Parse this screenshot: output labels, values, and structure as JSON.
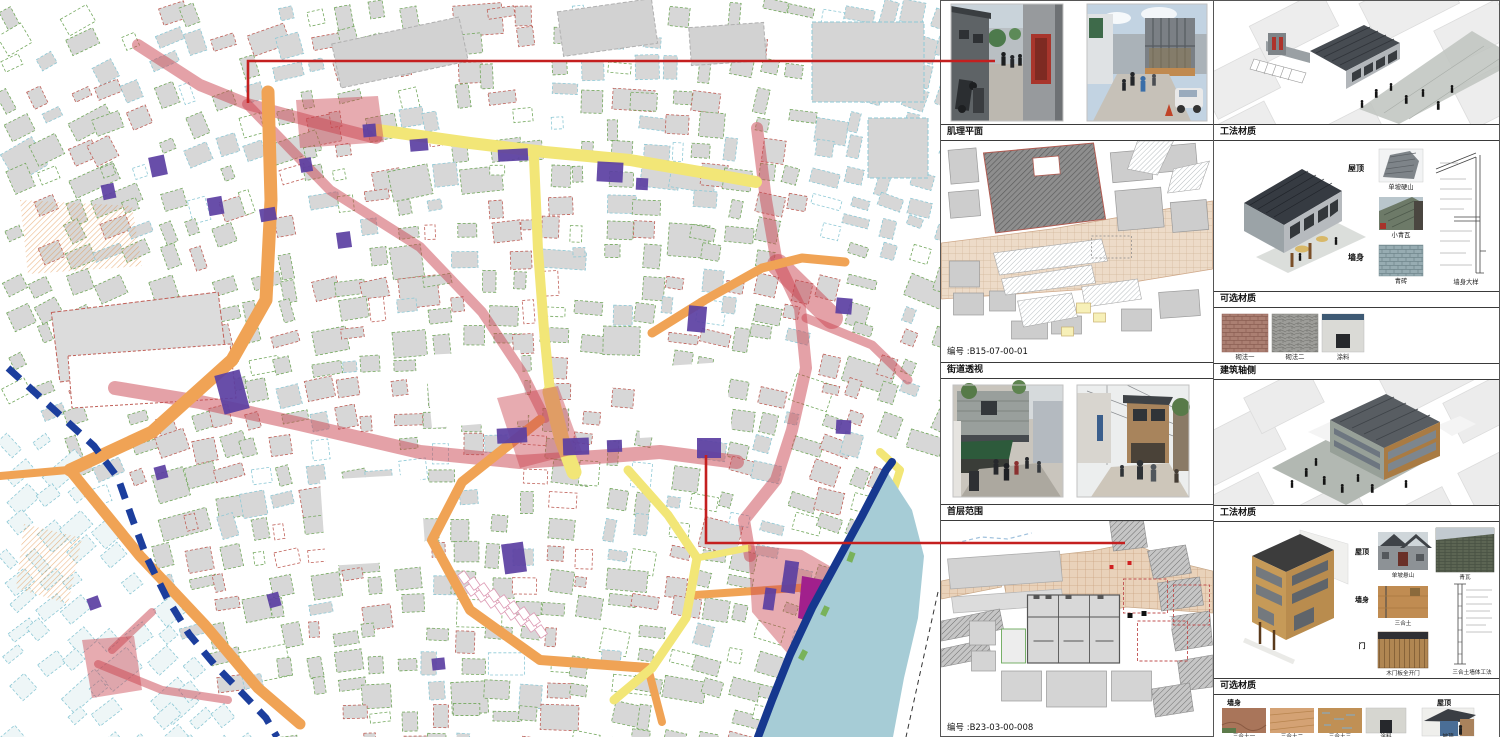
{
  "panels": {
    "texture_plan": {
      "label": "肌理平面",
      "code": "编号 :B15-07-00-01"
    },
    "method_materials_top": {
      "label": "工法材质",
      "roof_group": "屋顶",
      "roof_item_1": "单坡硬山",
      "roof_item_2": "小青瓦",
      "wall_group": "墙身",
      "wall_item": "青砖",
      "detail_caption": "墙身大样"
    },
    "optional_materials_top": {
      "label": "可选材质",
      "swatches": [
        "砌法一",
        "砌法二",
        "涂料"
      ]
    },
    "street_perspective": {
      "label": "街道透视"
    },
    "building_axon": {
      "label": "建筑轴侧"
    },
    "ground_floor_plan": {
      "label": "首层范围",
      "code": "编号 :B23-03-00-008"
    },
    "method_materials_bottom": {
      "label": "工法材质",
      "roof_group": "屋顶",
      "roof_item_1": "单坡悬山",
      "roof_item_2": "青瓦",
      "wall_group": "墙身",
      "wall_item": "三合土",
      "door_group": "门",
      "door_item": "木门板全开门",
      "detail_caption": "三合土墙体工法"
    },
    "optional_materials_bottom": {
      "label": "可选材质",
      "wall_group": "墙身",
      "wall_swatches": [
        "三合土一",
        "三合土二",
        "三合土三",
        "涂料"
      ],
      "roof_group": "屋顶",
      "roof_swatch": "坡顶"
    }
  },
  "map": {
    "legend_colors": {
      "primary_street_red": "#cc4a55",
      "secondary_street_orange": "#f0a355",
      "lane_yellow": "#f2e677",
      "key_building_purple": "#5b3fa2",
      "special_building_magenta": "#a1208c",
      "historic_wall_blue": "#1c3e9d",
      "river": "#a6ccd6",
      "callout_line_red": "#c41f1f"
    }
  }
}
